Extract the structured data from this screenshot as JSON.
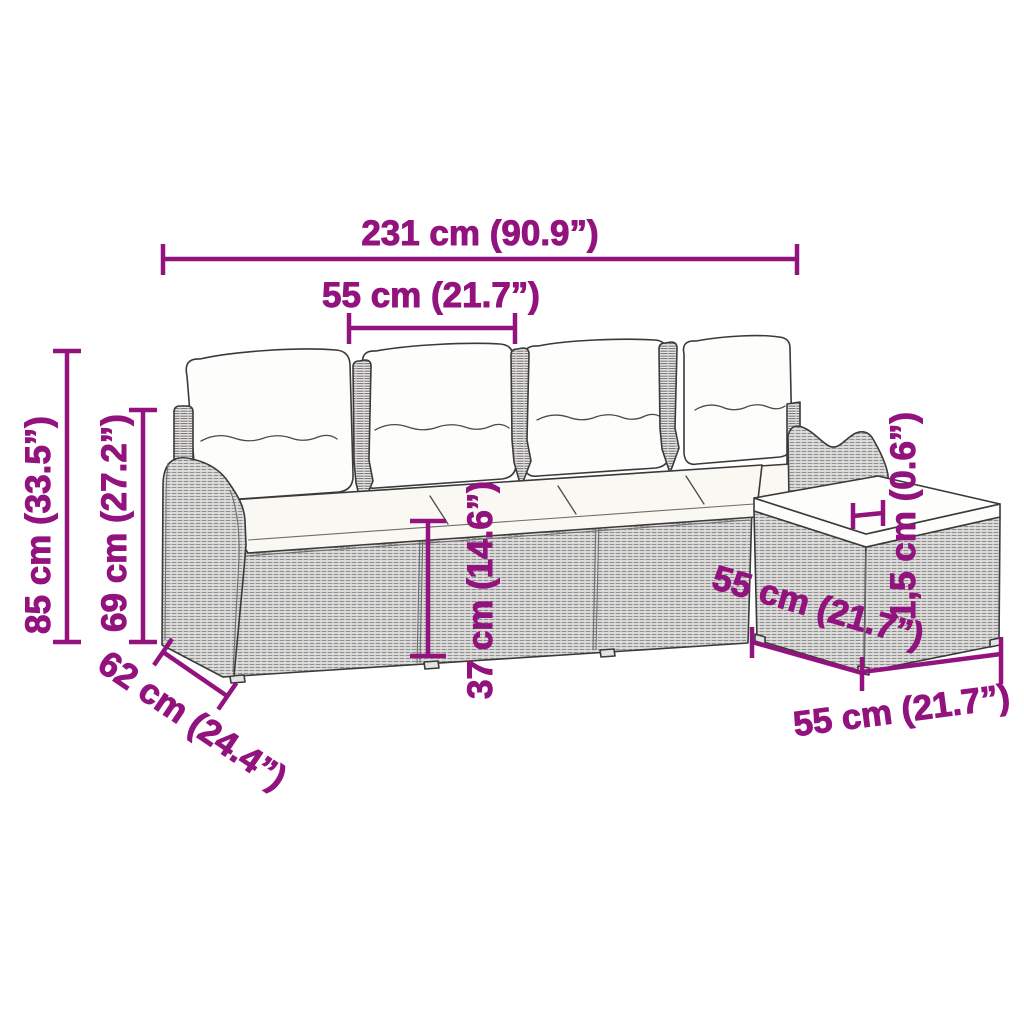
{
  "diagram": {
    "accent_color": "#93137E",
    "line_art_color": "#3a3a3a",
    "background": "#ffffff"
  },
  "dims": {
    "overall_width": {
      "label": "231 cm (90.9”)"
    },
    "seat_module_width": {
      "label": "55 cm (21.7”)"
    },
    "overall_height": {
      "label": "85 cm (33.5”)"
    },
    "backrest_height": {
      "label": "69 cm (27.2”)"
    },
    "seat_height": {
      "label": "37 cm (14.6”)"
    },
    "cushion_thickness": {
      "label": "1,5 cm (0.6”)"
    },
    "sofa_depth": {
      "label": "62 cm (24.4”)"
    },
    "footstool_depth": {
      "label": "55 cm (21.7”)"
    },
    "footstool_width": {
      "label": "55 cm (21.7”)"
    }
  }
}
